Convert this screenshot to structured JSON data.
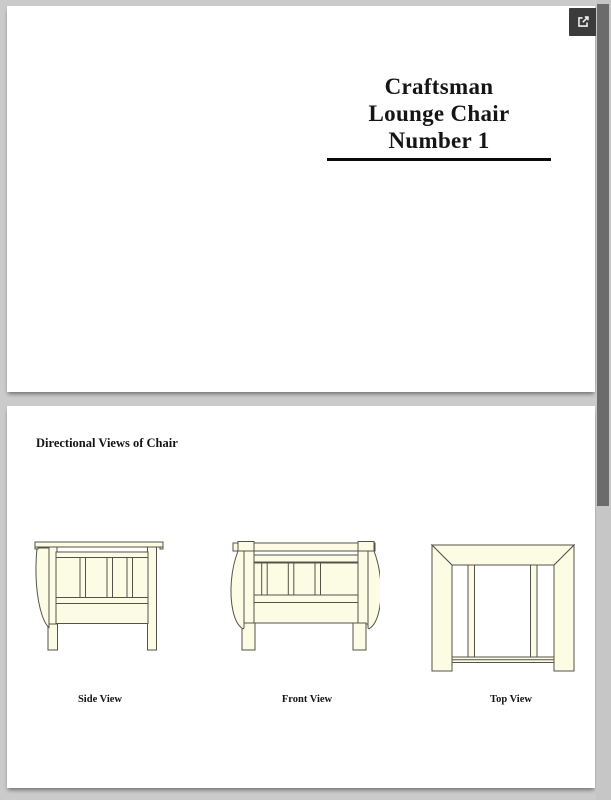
{
  "toolbar": {
    "icons": {
      "open_in_new": "open-in-new-icon"
    }
  },
  "document": {
    "page1": {
      "title_lines": [
        "Craftsman",
        "Lounge Chair",
        "Number 1"
      ]
    },
    "page2": {
      "heading": "Directional Views of Chair",
      "views": [
        {
          "label": "Side View"
        },
        {
          "label": "Front View"
        },
        {
          "label": "Top View"
        }
      ]
    }
  },
  "colors": {
    "chair_fill": "#FCFCE5",
    "chair_outline": "#53534A",
    "button_bg": "#3B3B3B",
    "scrollbar_thumb": "#6B6B6B",
    "title_rule": "#0A0A0A"
  }
}
